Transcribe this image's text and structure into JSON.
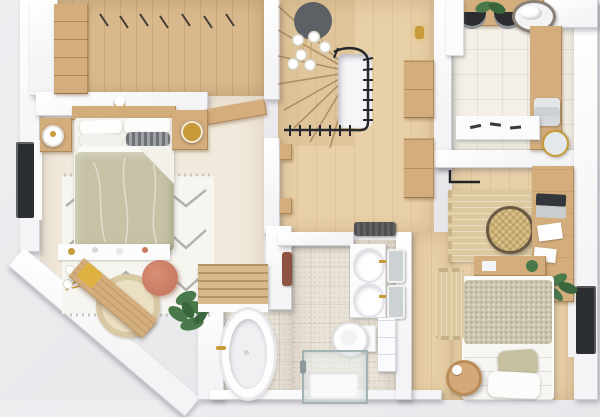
{
  "scene": {
    "type": "3d-floor-plan-render",
    "view": "top-down",
    "rooms": [
      {
        "name": "master-bedroom",
        "floor": "carpet",
        "furniture": [
          "wardrobe-closet",
          "hanger-rail",
          "double-bed",
          "nightstand-left",
          "nightstand-right",
          "wall-lamp-left",
          "wall-lamp-right",
          "chevron-rug",
          "console-ledge",
          "wood-bench",
          "round-jute-rug",
          "coral-pouf",
          "potted-plant",
          "slatted-bench",
          "window"
        ]
      },
      {
        "name": "stair-hall",
        "floor": "wood",
        "furniture": [
          "winder-staircase",
          "stairwell-void",
          "black-railing",
          "pendant-light-cluster",
          "wall-sconce",
          "closet-doors",
          "wall-hooks",
          "doormat"
        ]
      },
      {
        "name": "bathroom",
        "floor": "tile",
        "furniture": [
          "freestanding-tub",
          "double-sink-vanity",
          "mirrors",
          "toilet",
          "storage-cabinet",
          "glass-shower",
          "hanging-towel"
        ]
      },
      {
        "name": "laundry-room",
        "floor": "tile-big",
        "furniture": [
          "washer",
          "dryer",
          "wood-counter",
          "towel-basket",
          "towel-stack",
          "round-tray",
          "white-console",
          "tall-cabinet",
          "small-plant"
        ]
      },
      {
        "name": "second-bedroom",
        "floor": "wood",
        "furniture": [
          "single-bed",
          "tweed-blanket",
          "pillows",
          "desk",
          "laptop",
          "papers",
          "rattan-chair",
          "woven-rug",
          "jute-runner",
          "wall-shelf",
          "side-stool",
          "clothes-rail",
          "desk-plant",
          "window"
        ]
      }
    ]
  },
  "palette": {
    "outside": "#e9e9ec",
    "outside-light": "#efeff2",
    "outside-dark": "#e0e0e5",
    "wall": "#f4f4f6",
    "wood": "#e8d0a8",
    "wood-dark": "#d9b98c",
    "furn-wood": "#d3ad7c",
    "carpet": "#f1e9db",
    "tile": "#e9e2d6",
    "tile-light": "#f4f0e8",
    "rug-white": "#f7f5f0",
    "rug-chevron": "#b3b1ac",
    "duvet-sage": "#c6c2a6",
    "tweed": "#cdc4ae",
    "jute": "#dcc9a0",
    "coral": "#c97a62",
    "plant-green": "#4a7a4b",
    "plant-green-dk": "#39663c",
    "gold": "#c79a3a",
    "yellow-throw": "#dfb13e",
    "railing-black": "#26282c",
    "pendant-gray": "#5d6165",
    "terracotta": "#8f5140",
    "glass": "#a3b2b4",
    "window-dark": "#2b2e31",
    "mat-dark": "#4f4f4f",
    "appliance-dark": "#2c2d30"
  }
}
